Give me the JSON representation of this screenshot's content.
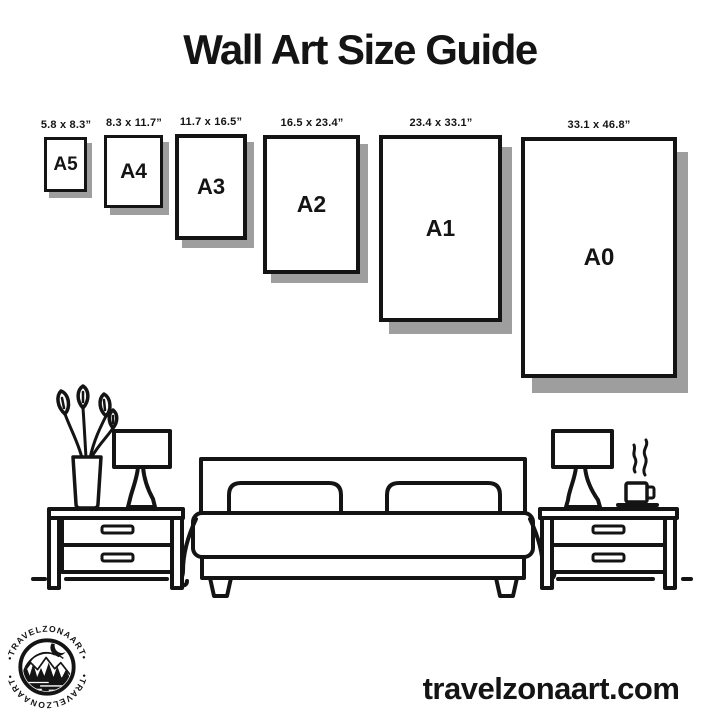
{
  "title": "Wall Art Size Guide",
  "size_guide": {
    "sizes": [
      {
        "name": "A5",
        "dimensions": "5.8 x 8.3”"
      },
      {
        "name": "A4",
        "dimensions": "8.3 x 11.7”"
      },
      {
        "name": "A3",
        "dimensions": "11.7 x 16.5”"
      },
      {
        "name": "A2",
        "dimensions": "16.5 x 23.4”"
      },
      {
        "name": "A1",
        "dimensions": "23.4 x 33.1”"
      },
      {
        "name": "A0",
        "dimensions": "33.1 x 46.8”"
      }
    ]
  },
  "scene": {
    "items": [
      "potted-plant",
      "table-lamp",
      "nightstand",
      "double-bed",
      "coffee-cup",
      "floor-line"
    ]
  },
  "branding": {
    "logo_text": "•TRAVELZONAART•",
    "website": "travelzonaart.com"
  },
  "colors": {
    "ink": "#141414",
    "shadow": "#9e9e9e",
    "background": "#ffffff"
  }
}
